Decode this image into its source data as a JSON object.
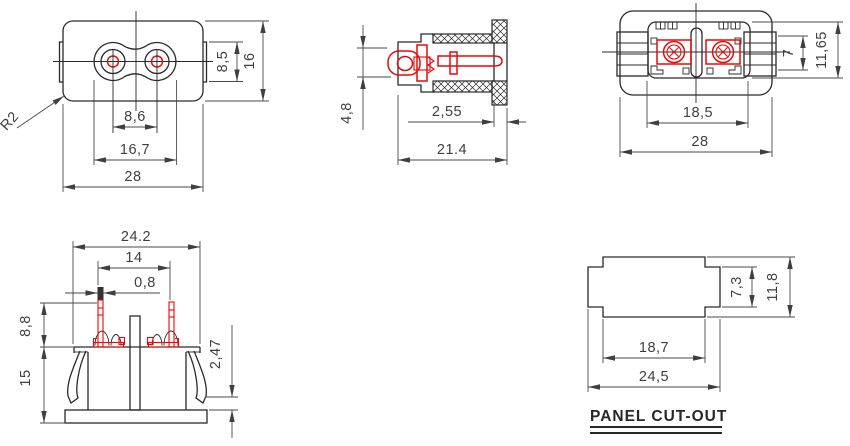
{
  "drawing": {
    "title": "PANEL CUT-OUT",
    "colors": {
      "object_line": "#2a2a2a",
      "dimension_line": "#4a4a4a",
      "highlight_red": "#e60a0a",
      "text": "#3f3f3f"
    },
    "views": {
      "front": {
        "name": "front view",
        "dims": {
          "overall_width": "28",
          "lobe_span": "16,7",
          "pin_pitch": "8,6",
          "socket_height": "8,5",
          "overall_height": "16",
          "corner_radius": "R2"
        }
      },
      "side_section": {
        "name": "side section view",
        "dims": {
          "head_height": "4,8",
          "rear_wall": "2,55",
          "overall_depth": "21.4"
        }
      },
      "rear": {
        "name": "rear view",
        "dims": {
          "rib_span": "7",
          "pocket_height": "11,65",
          "pocket_width": "18,5",
          "overall_width": "28"
        }
      },
      "mount": {
        "name": "mounting side view",
        "dims": {
          "top_width": "24.2",
          "pin_pitch": "14",
          "pin_width": "0,8",
          "pin_length": "8,8",
          "body_height": "15",
          "standoff": "2,47"
        }
      },
      "panel_cutout": {
        "name": "panel cut-out",
        "label": "PANEL CUT-OUT",
        "dims": {
          "slot_height": "7,3",
          "overall_height": "11,8",
          "slot_width": "18,7",
          "overall_width": "24,5"
        }
      }
    }
  }
}
